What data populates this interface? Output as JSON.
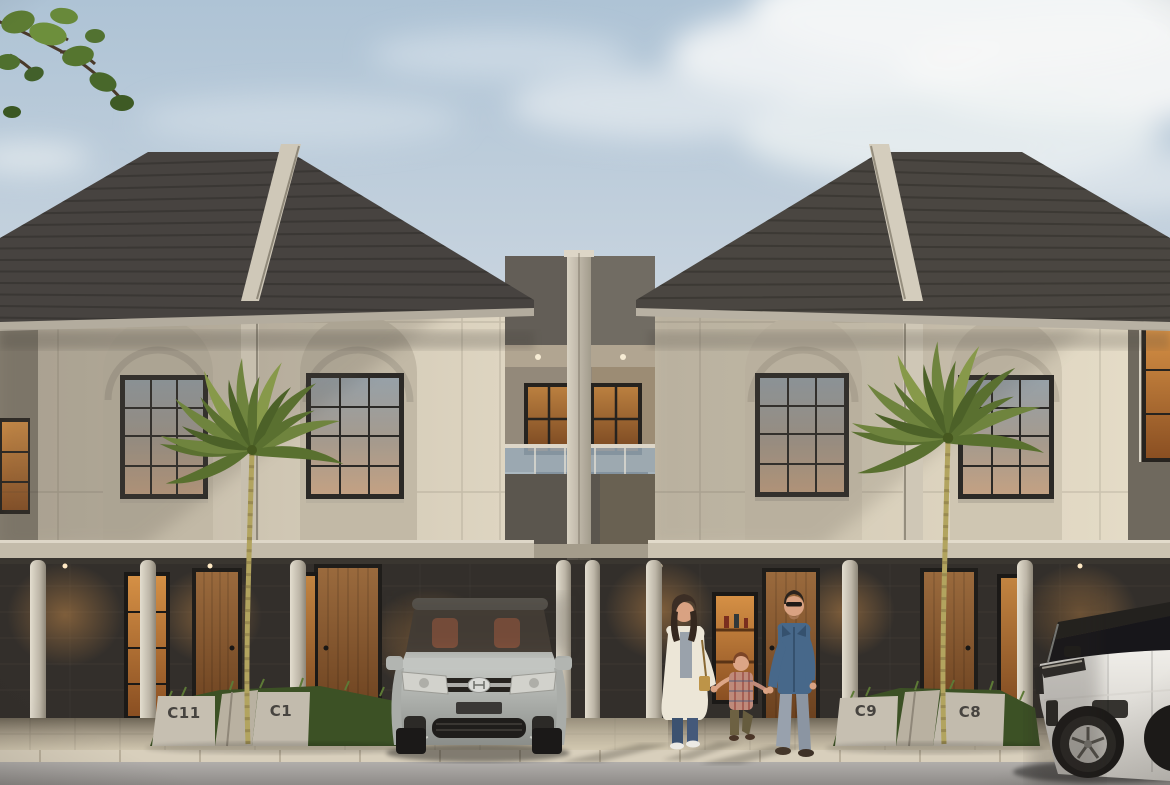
{
  "title": "Townhouse Row Exterior Render at Dusk",
  "units": [
    {
      "label": "C11"
    },
    {
      "label": "C1"
    },
    {
      "label": "C9"
    },
    {
      "label": "C8"
    }
  ],
  "palette": {
    "sky_top": "#aec3d5",
    "sky_bottom": "#d9e1e7",
    "cloud": "#f3f5f6",
    "roof_tile": "#474340",
    "ridge_cap": "#cdc5b4",
    "facade_upper": "#d9d0bd",
    "facade_recess": "#8f887a",
    "ground_wall": "#332f2b",
    "door_wood": "#8a5a33",
    "warm_window_light": "#cd8a45",
    "grass": "#3f5426",
    "palm_leaf": "#6f843e",
    "planter_concrete": "#c6bfb1",
    "walkway": "#b3a992",
    "curb": "#d8cfbc",
    "road": "#9f9c99",
    "silver_car_body": "#b6b9b5",
    "white_car_body": "#eae8e3",
    "denim_jacket": "#47688a",
    "woman_coat": "#ece6d7"
  },
  "entities": {
    "left_vehicle": "silver-hyundai-suv-front-view",
    "right_vehicle": "white-luxury-suv-three-quarter-view",
    "people": [
      "woman-in-cream-coat",
      "child-in-plaid-shirt",
      "man-in-denim-jacket"
    ],
    "vegetation": [
      "overhanging-branch-top-left",
      "palm-left-planter",
      "palm-right-planter",
      "grass-planters"
    ]
  }
}
